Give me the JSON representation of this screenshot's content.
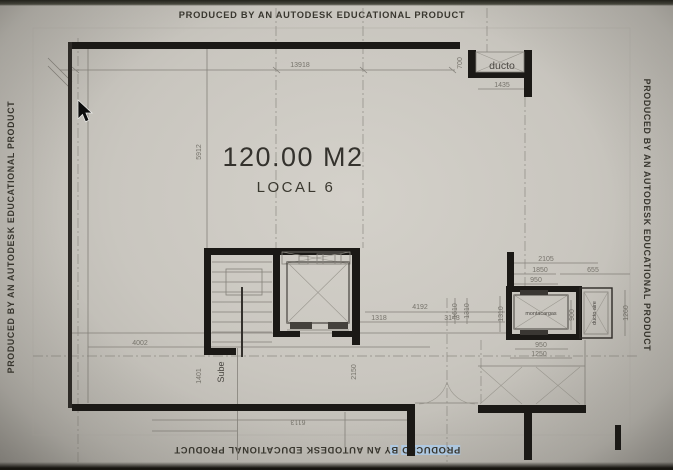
{
  "banners": {
    "watermark": "PRODUCED BY AN AUTODESK EDUCATIONAL PRODUCT",
    "bottom_highlight_1": "PRODUCED",
    "bottom_space": " ",
    "bottom_highlight_2": "B",
    "bottom_rest": "Y AN AUTODESK EDUCATIONAL PRODUCT"
  },
  "plan": {
    "area_label": "120.00 M2",
    "local_label": "LOCAL 6",
    "labels": {
      "ducto": "ducto",
      "montacargas": "montacargas",
      "ducto_aire": "ducto aire",
      "stairs_direction": "Sube"
    },
    "dimensions": {
      "top_width": "13918",
      "left_height": "5912",
      "ducto_width": "1435",
      "ducto_height": "700",
      "lower_left_width": "4002",
      "lower_mid_total": "4192",
      "lower_mid_a": "1318",
      "lower_mid_b": "3143",
      "shaft_v1": "1610",
      "shaft_v2": "1310",
      "mc_top_total": "2105",
      "mc_top_a": "1850",
      "mc_top_b": "655",
      "mc_top_c": "950",
      "mc_left_v": "1310",
      "mc_cab_v": "900",
      "ducto_aire_v": "1260",
      "mc_bottom_a": "950",
      "mc_bottom_b": "1250",
      "bottom_width": "6113",
      "elev_right_v": "2150",
      "stair_left_v": "1401"
    }
  },
  "colors": {
    "paper": "#c9c6bf",
    "wall": "#1b1916",
    "selection_highlight": "#b4cfe9",
    "dim_text": "#76736b"
  }
}
